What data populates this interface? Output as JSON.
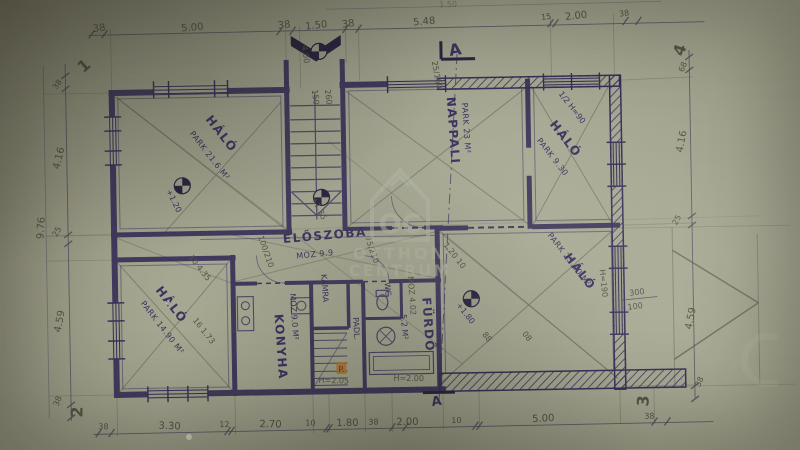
{
  "rooms": {
    "bedroom_tl": {
      "name": "HÁLÓ",
      "floor": "PARK 21.6 M²"
    },
    "bedroom_bl": {
      "name": "HÁLÓ",
      "floor": "PARK 14.90 M²"
    },
    "bedroom_tr": {
      "name": "HÁLÓ",
      "floor": "PARK 9.30",
      "note": "1/2 H=90"
    },
    "bedroom_br": {
      "name": "HÁLÓ",
      "floor": "PARK 23.00 M²",
      "height": "H=190"
    },
    "living": {
      "name": "NAPPALI",
      "floor": "PARK 23 M²",
      "window": "25/160"
    },
    "hall": {
      "name": "ELŐSZOBA",
      "floor": "MOZ 9.9"
    },
    "kitchen": {
      "name": "KONYHA",
      "floor": "MOZ 9.0 M²"
    },
    "pantry": {
      "name": "KAMRA"
    },
    "bath": {
      "name": "FÜRDŐ",
      "floor": "MOZ 4.02",
      "area": "5.2 M²"
    },
    "wc": {
      "name": "WC"
    },
    "attic": {
      "name": "PADL.",
      "mark": "P."
    }
  },
  "levels": {
    "entry": "4.00",
    "bedroom_tl": "+1.20",
    "stair": "+1.35",
    "bedroom_br": "+1.80"
  },
  "doors": {
    "stair_w": "150",
    "stair_h": "260",
    "hall_left": "100/210",
    "hall_right": "75/210"
  },
  "dims": {
    "top": [
      "38",
      "5.00",
      "38",
      "1.50",
      "38",
      "5.48",
      "15",
      "2.00",
      "38"
    ],
    "top_partial": "1.50",
    "bottom": [
      "38",
      "3.30",
      "12",
      "2.70",
      "10",
      "1.80",
      "38",
      "2.00",
      "10",
      "5.00",
      "38"
    ],
    "left": [
      "38",
      "4.16",
      "25",
      "4.59",
      "38"
    ],
    "left_total": "9.76",
    "right": [
      "68",
      "4.16",
      "25",
      "4.59",
      "38"
    ],
    "window_w": "300",
    "window_h": "100",
    "inner_a": "10  4.35",
    "inner_b": "16  1.73",
    "inner_c": "1.20  10",
    "inner_d": "88",
    "inner_e": "08",
    "head_a": "H=2.05",
    "head_b": "H=2.00"
  },
  "markers": {
    "c1": "1",
    "c2": "2",
    "c3": "3",
    "c4": "4",
    "section": "A"
  },
  "watermark": {
    "logo": "OC",
    "line1": "OTTHON",
    "line2": "CENTRUM"
  }
}
